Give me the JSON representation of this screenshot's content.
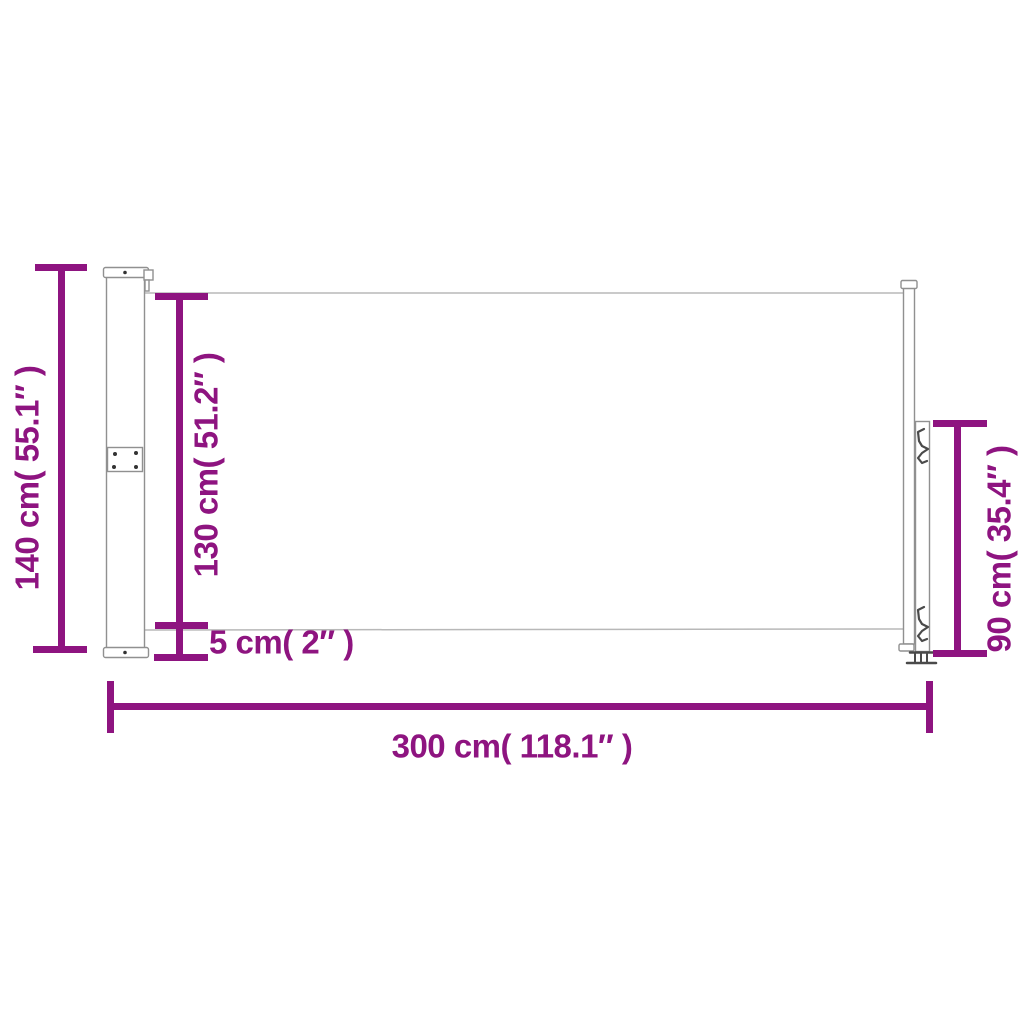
{
  "diagram": {
    "name": "retractable-side-awning-dimension-diagram",
    "colors": {
      "dimension_accent": "#8E1480",
      "drawing_outline": "#909090",
      "fabric_line": "#b8b8b8",
      "hardware_dark": "#4a4a4a"
    },
    "dimensions": {
      "total_height": {
        "label": "140 cm( 55.1″ )",
        "cm": 140,
        "inches": 55.1
      },
      "fabric_height": {
        "label": "130 cm( 51.2″ )",
        "cm": 130,
        "inches": 51.2
      },
      "bottom_gap": {
        "label": "5 cm( 2″ )",
        "cm": 5,
        "inches": 2
      },
      "handle_post_height": {
        "label": "90 cm( 35.4″ )",
        "cm": 90,
        "inches": 35.4
      },
      "total_length": {
        "label": "300 cm( 118.1″ )",
        "cm": 300,
        "inches": 118.1
      }
    }
  }
}
